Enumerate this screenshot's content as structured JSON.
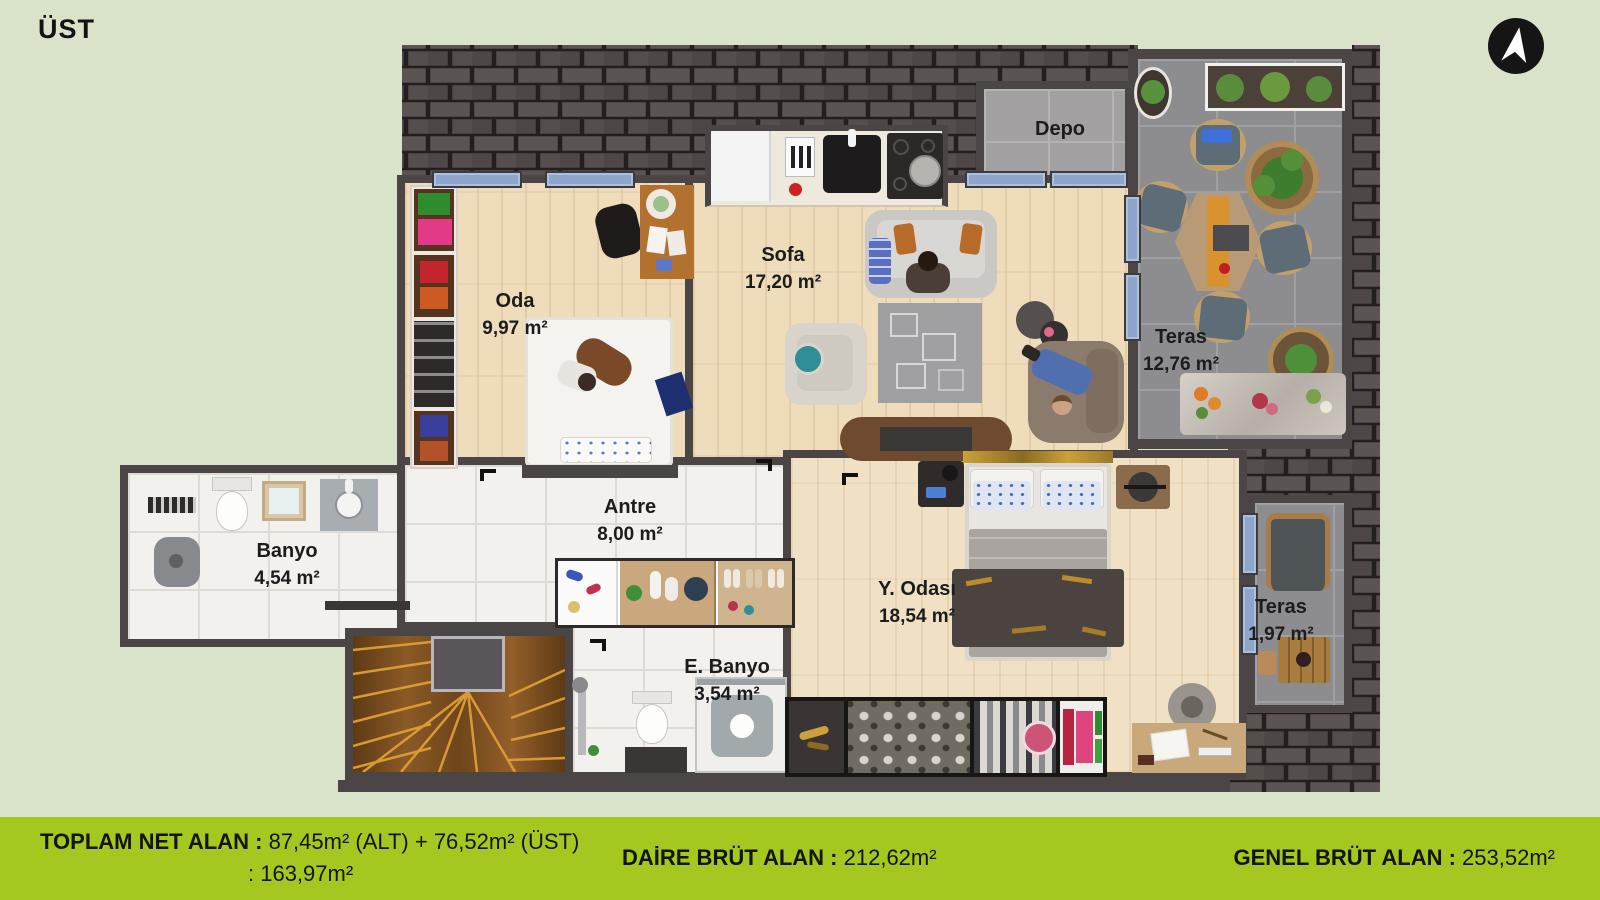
{
  "header": {
    "floor_label": "ÜST"
  },
  "icons": {
    "compass": "north-arrow-icon"
  },
  "rooms": {
    "depo": {
      "name": "Depo",
      "area": ""
    },
    "oda": {
      "name": "Oda",
      "area": "9,97 m²"
    },
    "sofa": {
      "name": "Sofa",
      "area": "17,20 m²"
    },
    "teras_large": {
      "name": "Teras",
      "area": "12,76 m²"
    },
    "antre": {
      "name": "Antre",
      "area": "8,00 m²"
    },
    "banyo": {
      "name": "Banyo",
      "area": "4,54 m²"
    },
    "y_odasi": {
      "name": "Y. Odası",
      "area": "18,54 m²"
    },
    "e_banyo": {
      "name": "E. Banyo",
      "area": "3,54 m²"
    },
    "teras_small": {
      "name": "Teras",
      "area": "1,97 m²"
    }
  },
  "footer": {
    "total_label": "TOPLAM NET ALAN :",
    "total_value": "87,45m² (ALT) + 76,52m² (ÜST)",
    "total_value2": ": 163,97m²",
    "daire_label": "DAİRE BRÜT ALAN :",
    "daire_value": "212,62m²",
    "genel_label": "GENEL BRÜT ALAN :",
    "genel_value": "253,52m²"
  },
  "colors": {
    "background": "#d9e3ca",
    "footer_bar": "#a5c821",
    "wall": "#4b4545",
    "roof_shingle": "#564d4d",
    "wood_floor": "#eedcba",
    "tile_floor": "#f3f1ee",
    "concrete_floor": "#8d8d90",
    "window": "#8ea6cc"
  }
}
